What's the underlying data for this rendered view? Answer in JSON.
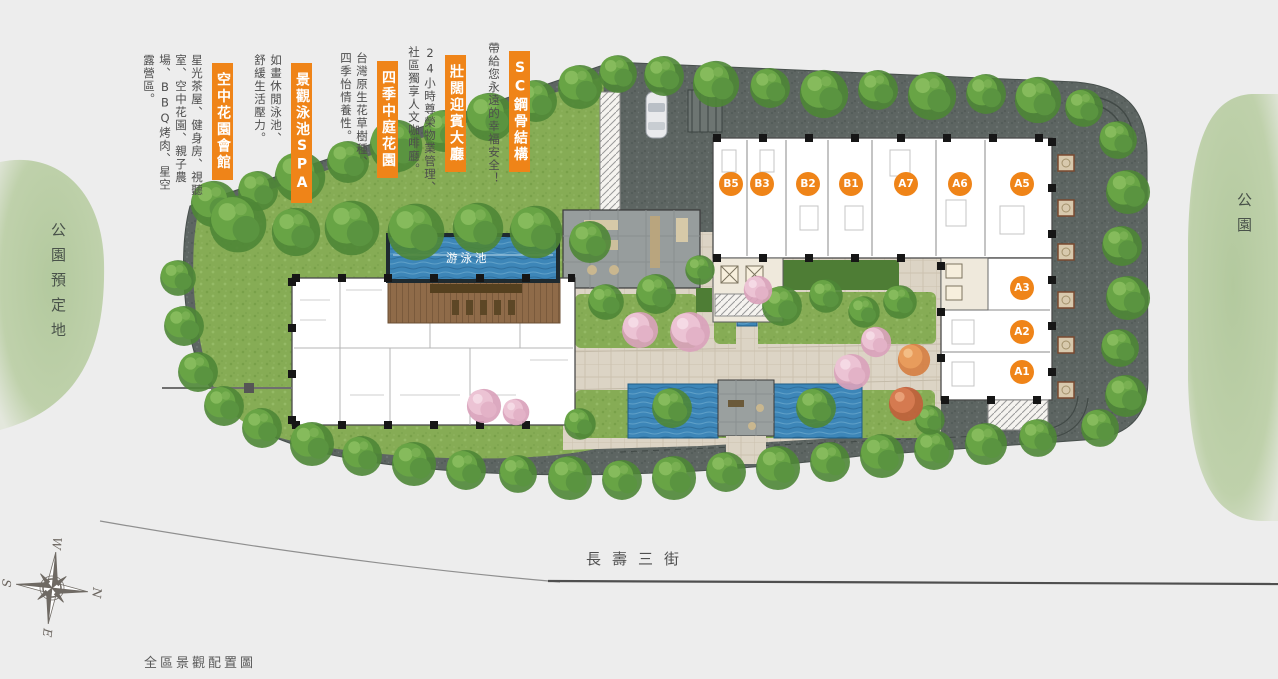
{
  "annotations": [
    {
      "title": "空中花園會館",
      "desc": "星光茶屋、健身房、視聽室、空中花園、親子農場、BBQ烤肉、星空露營區。"
    },
    {
      "title": "景觀泳池SPA",
      "desc": "如畫休閒泳池、舒緩生活壓力。"
    },
    {
      "title": "四季中庭花園",
      "desc": "台灣原生花草樹種、四季怡情養性。"
    },
    {
      "title": "壯闊迎賓大廳",
      "desc": "24小時尊榮物業管理、社區獨享人文咖啡廳。"
    },
    {
      "title": "SC鋼骨結構",
      "desc": "帶給您永遠的幸福安全！"
    }
  ],
  "units": [
    "B5",
    "B3",
    "B2",
    "B1",
    "A7",
    "A6",
    "A5",
    "A3",
    "A2",
    "A1"
  ],
  "map": {
    "pool_label": "游泳池",
    "street_label": "長壽三街",
    "park_left_label": "公園預定地",
    "park_right_label": "公園"
  },
  "compass": {
    "n": "N",
    "e": "E",
    "s": "S",
    "w": "W"
  },
  "caption": "全區景觀配置圖",
  "colors": {
    "accent_orange": "#ef8418",
    "granite_paving": "#5d6562",
    "lawn_green": "#86ac55",
    "pool_blue": "#3d86b8",
    "paving_beige": "#dcd4c5",
    "wood_deck": "#8f6b49",
    "park_green": "#b7cca3",
    "background": "#ededed"
  }
}
